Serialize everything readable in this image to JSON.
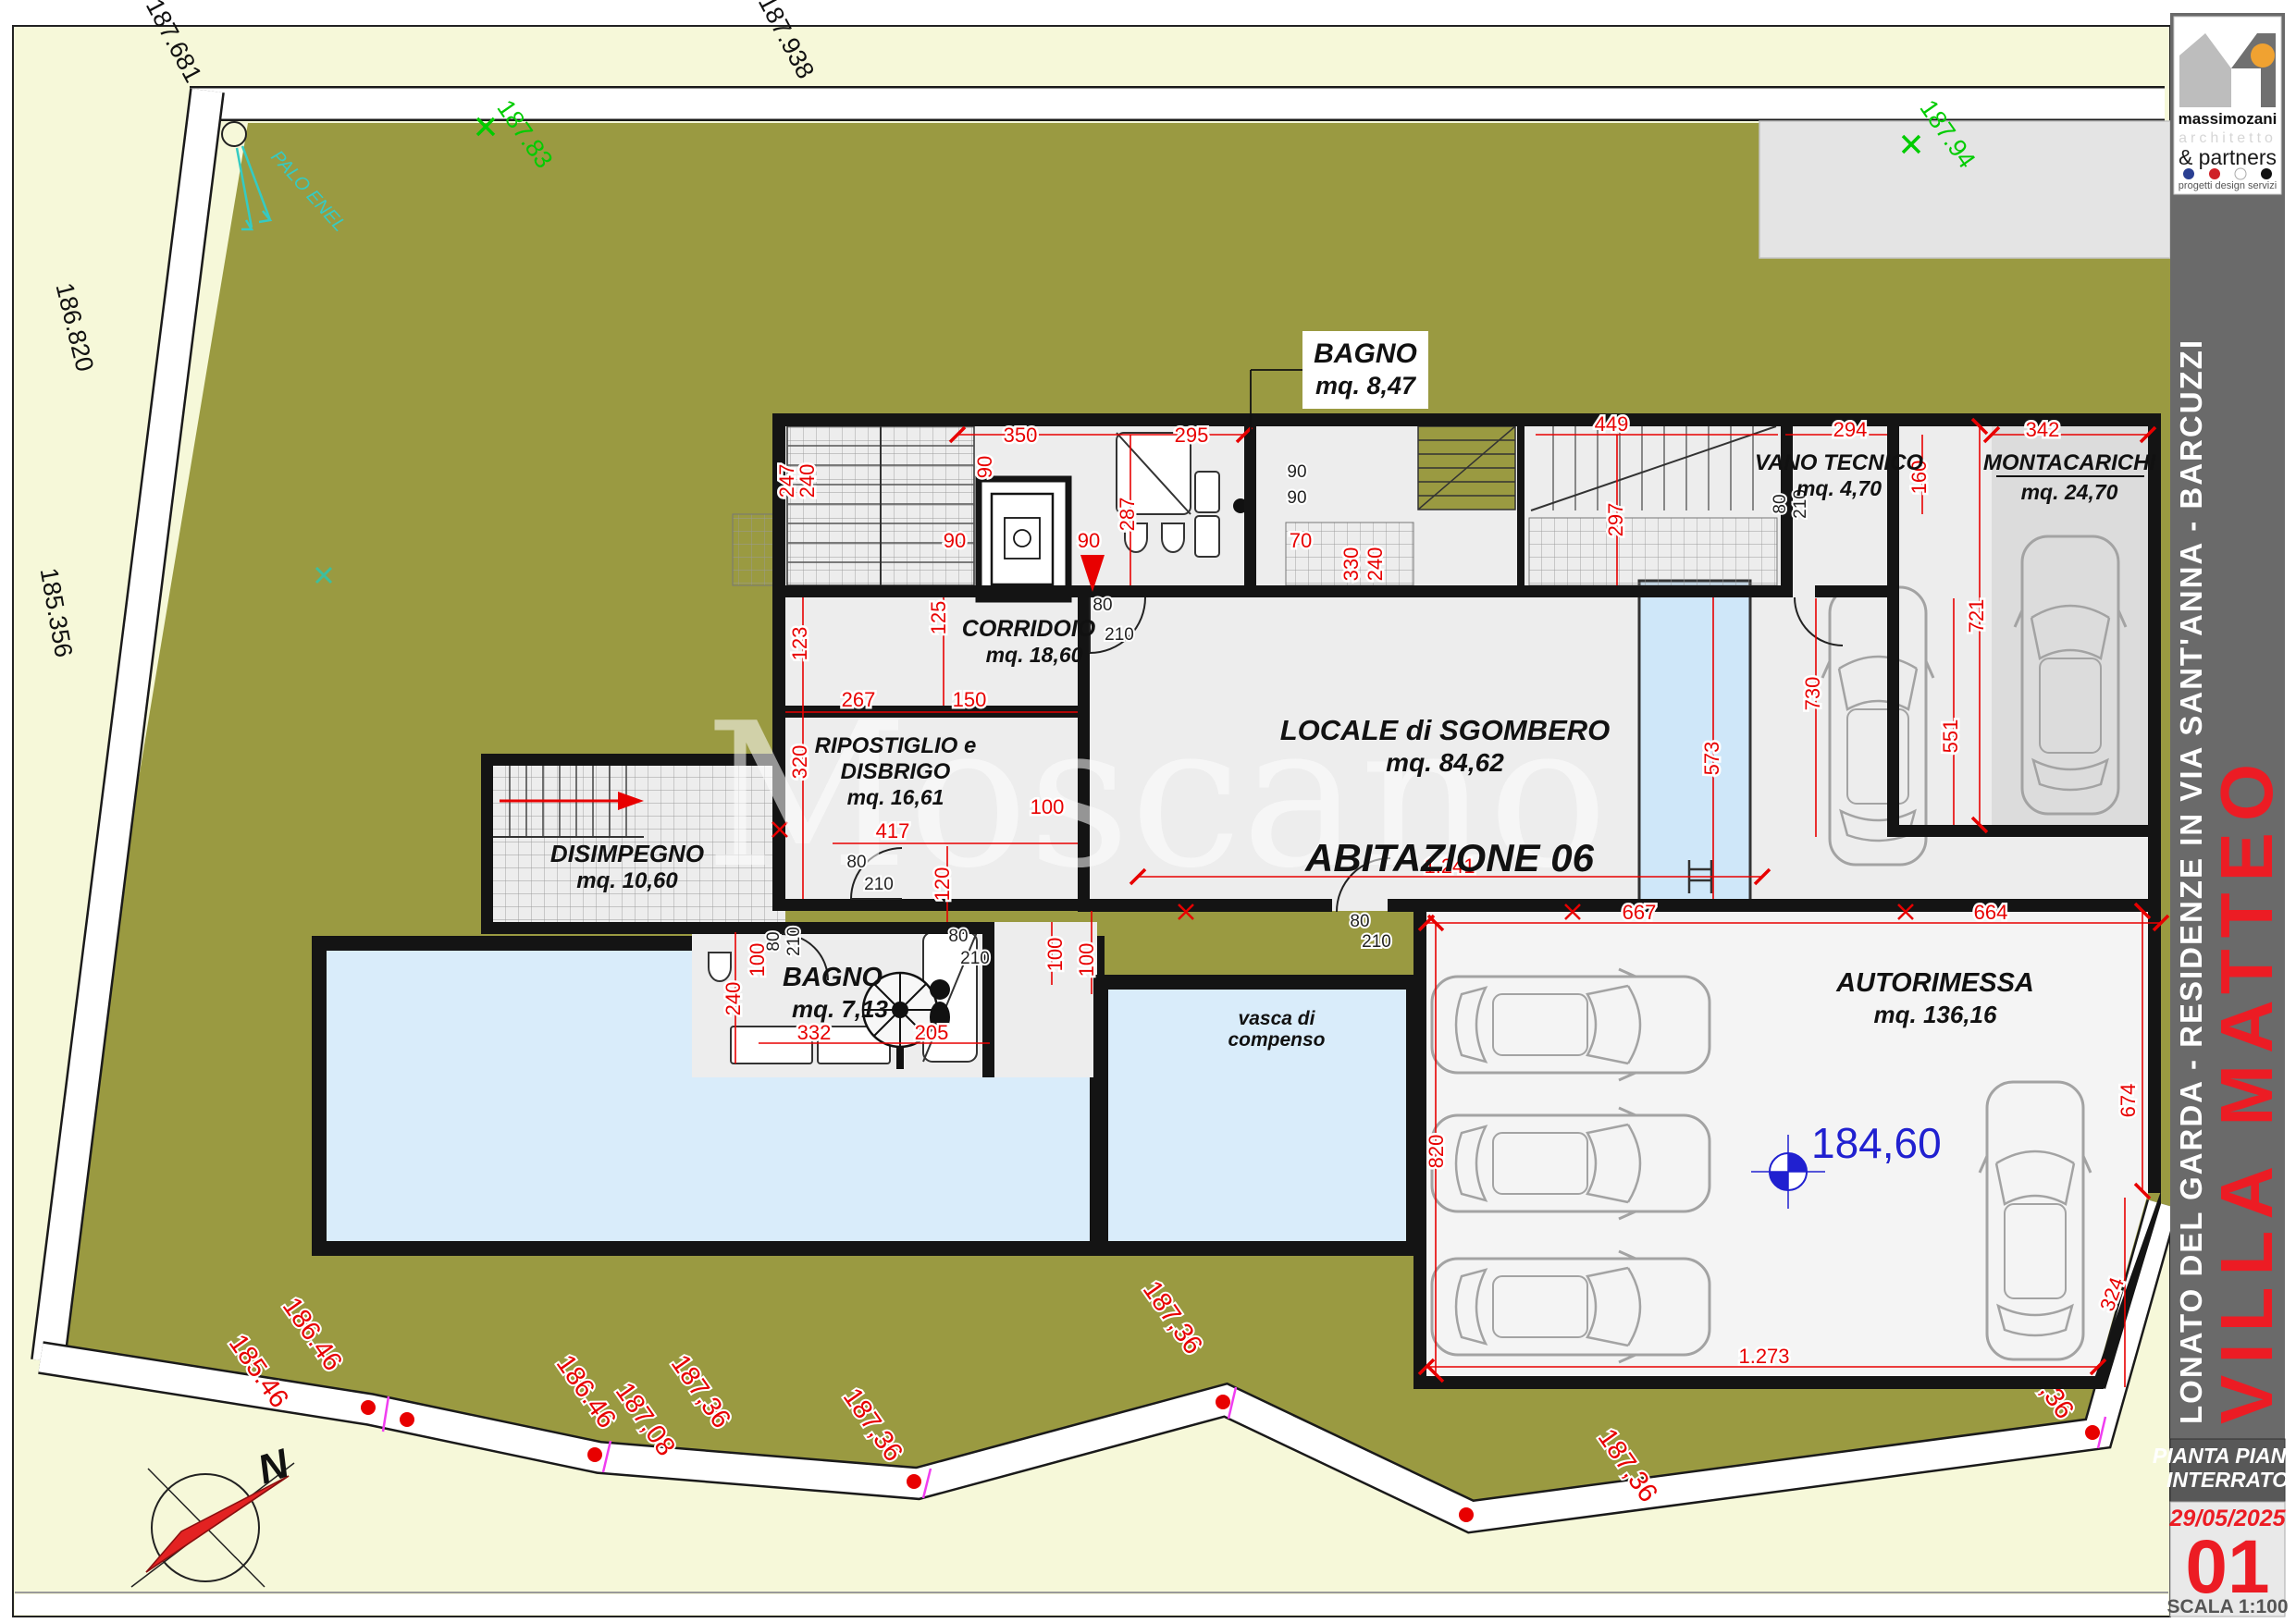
{
  "logo": {
    "name": "massimozani",
    "profession": "architetto",
    "partners": "& partners",
    "tagline": "progetti design servizi"
  },
  "sidebar": {
    "project_line": "LONATO DEL GARDA - RESIDENZE IN VIA SANT'ANNA - BARCUZZI",
    "project_name": "VILLA MATTEO"
  },
  "title_block": {
    "line1": "PIANTA PIANO",
    "line2": "INTERRATO",
    "date": "29/05/2025",
    "sheet": "01",
    "scale": "SCALA 1:100"
  },
  "rooms": {
    "bagno_top": {
      "name": "BAGNO",
      "area": "mq. 8,47"
    },
    "corridoio": {
      "name": "CORRIDOIO",
      "area": "mq. 18,60"
    },
    "ripostiglio": {
      "l1": "RIPOSTIGLIO e",
      "l2": "DISBRIGO",
      "area": "mq. 16,61"
    },
    "disimpegno": {
      "name": "DISIMPEGNO",
      "area": "mq. 10,60"
    },
    "locale": {
      "name": "LOCALE di SGOMBERO",
      "area": "mq. 84,62"
    },
    "vano": {
      "name": "VANO TECNICO",
      "area": "mq. 4,70"
    },
    "montacarichi": {
      "name": "MONTACARICHI",
      "area": "mq. 24,70"
    },
    "bagno2": {
      "name": "BAGNO",
      "area": "mq. 7,13"
    },
    "autorimessa": {
      "name": "AUTORIMESSA",
      "area": "mq. 136,16"
    }
  },
  "unit_label": "ABITAZIONE 06",
  "pool": {
    "l1": "vasca di",
    "l2": "compenso"
  },
  "level_marker": "184,60",
  "palo_enel": "PALO ENEL",
  "north": "N",
  "watermark": "Moscano",
  "site_levels": {
    "black": [
      "187.681",
      "187.938",
      "186.820",
      "185.356"
    ],
    "green": [
      "187.83",
      "187.94"
    ],
    "red": [
      "186.46",
      "185.46",
      "186.46",
      "187,08",
      "187,36",
      "187,36",
      "187,36",
      "187,36",
      "187,36"
    ]
  },
  "dims": [
    "350",
    "90",
    "295",
    "287",
    "90",
    "90",
    "70",
    "330",
    "240",
    "247",
    "240",
    "125",
    "123",
    "320",
    "267",
    "150",
    "100",
    "417",
    "120",
    "100",
    "449",
    "297",
    "294",
    "160",
    "342",
    "721",
    "551",
    "730",
    "573",
    "1.241",
    "667",
    "664",
    "820",
    "674",
    "1.273",
    "324",
    "332",
    "205",
    "100",
    "240",
    "100"
  ],
  "doors": [
    "80",
    "210",
    "80",
    "210",
    "80",
    "210",
    "80",
    "210",
    "80",
    "210",
    "80",
    "210",
    "90",
    "90"
  ],
  "colors": {
    "site_olive": "#9a9a41",
    "surround_pale": "#f6f8d9",
    "dim_red": "#e80000",
    "pool_blue": "#d9ecfa",
    "accent_blue": "#2020d0",
    "sidebar_gray": "#6a6a6a",
    "sheet_red": "#e8251f",
    "room_gray": "#ededed"
  }
}
